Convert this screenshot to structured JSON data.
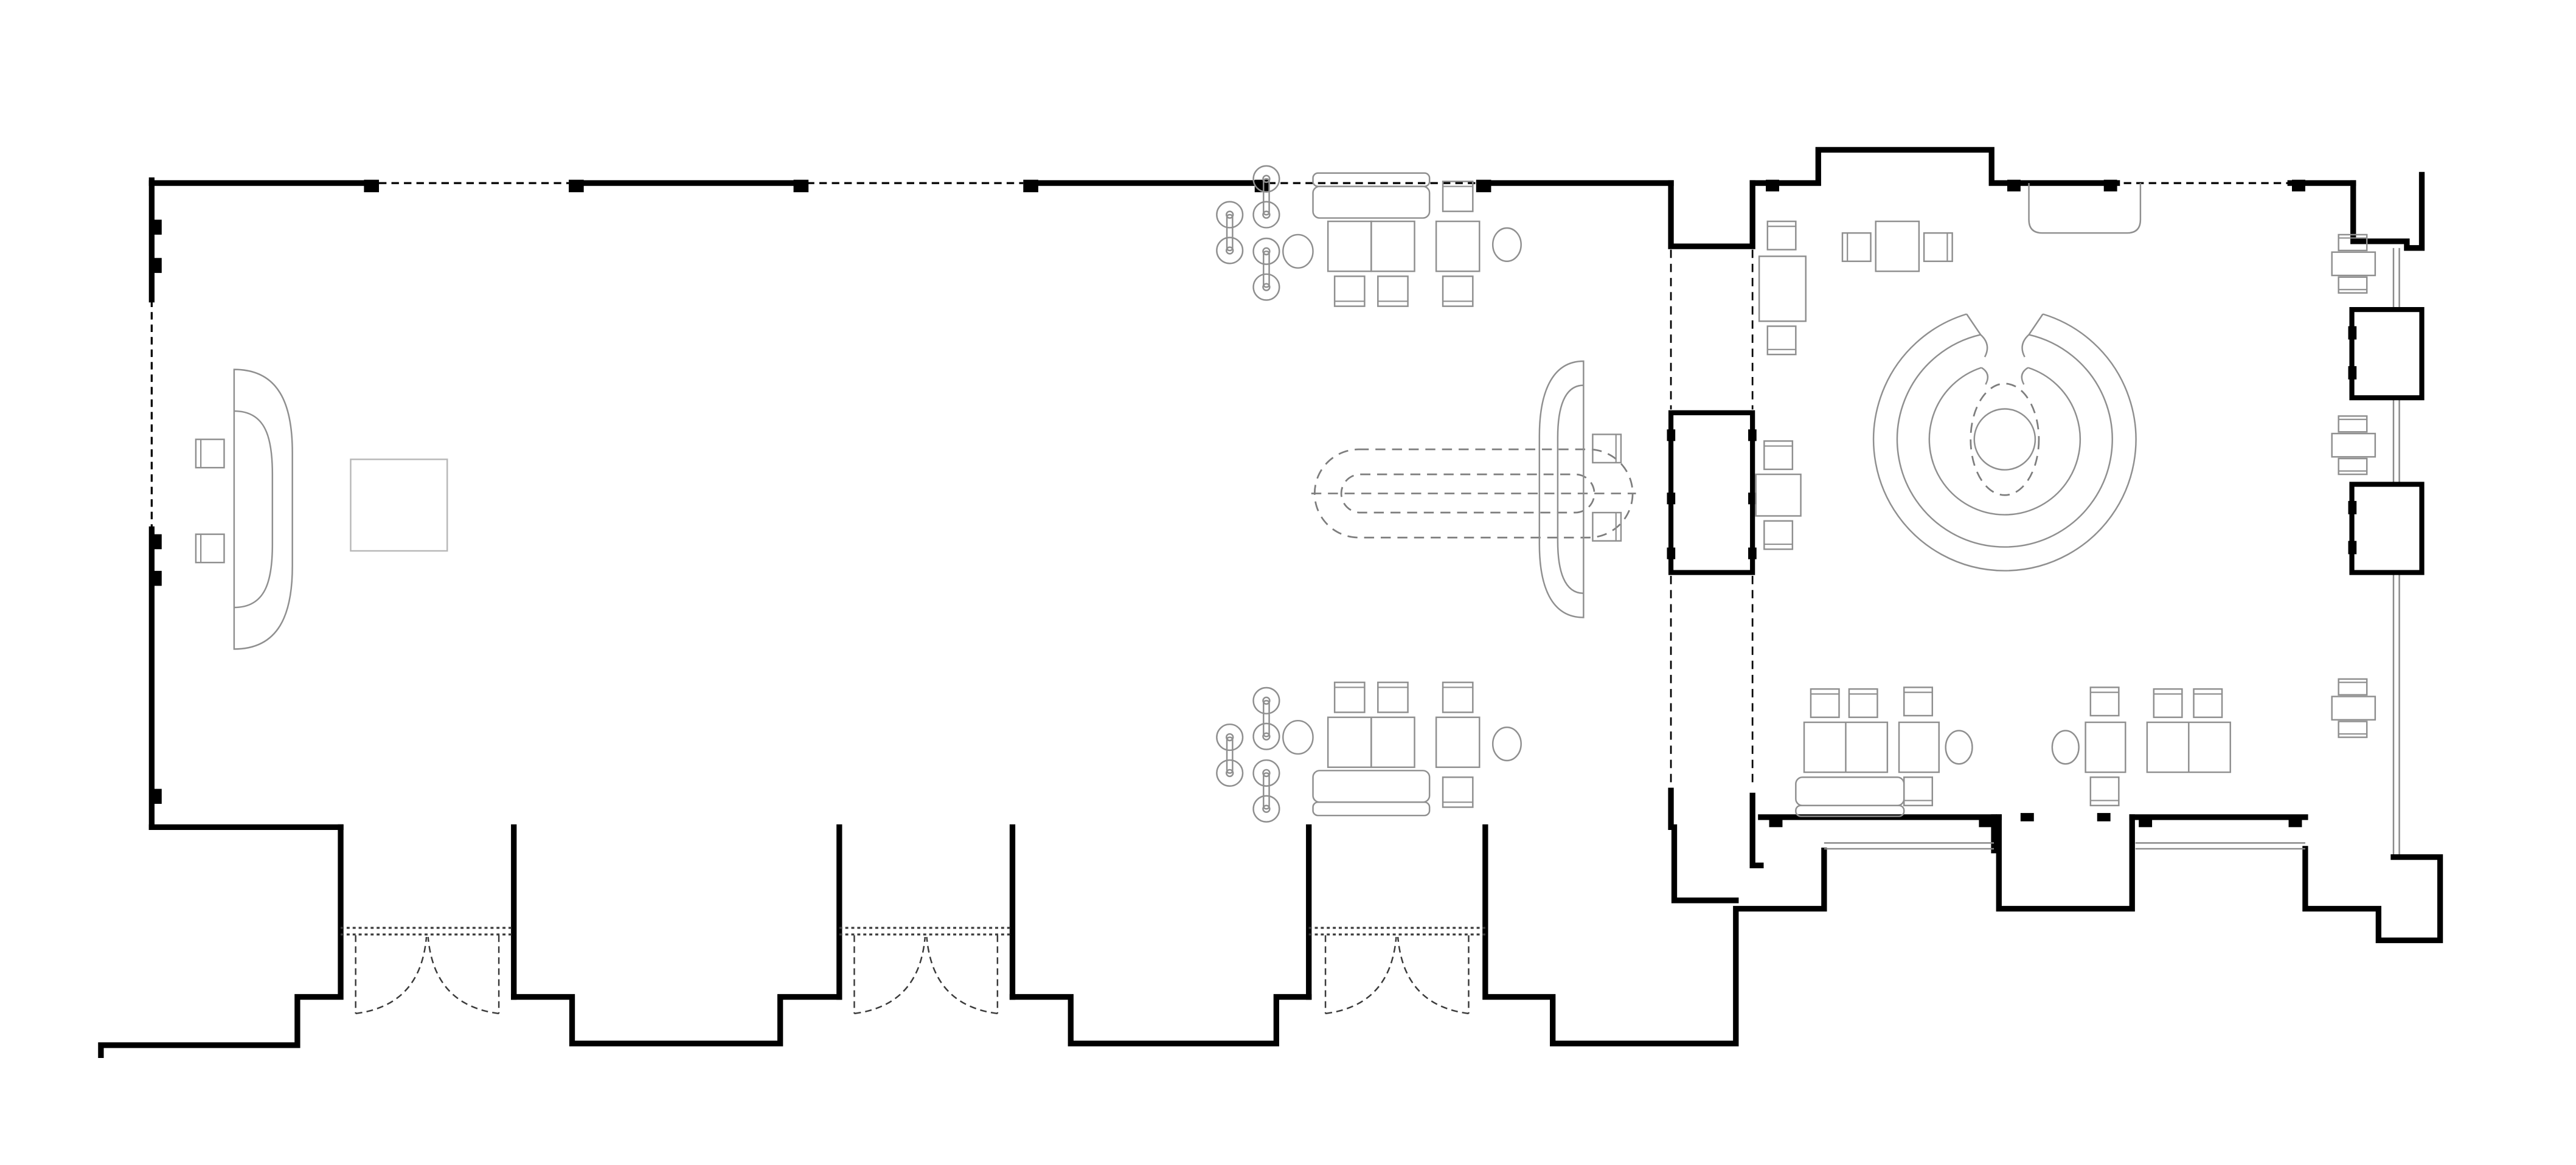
{
  "page": {
    "background": "#ffffff"
  },
  "drawing": {
    "type": "architectural-floor-plan",
    "view": "top-down plan, line drawing, no text labels",
    "colors": {
      "wall": "#000000",
      "furniture": "#8f8f8f",
      "furniture_light": "#b8b8b8",
      "opening_dash": "#3a3a3a",
      "overhead_dash": "#7d7d7d",
      "window": "#8a8a8a",
      "background": "#ffffff"
    },
    "rooms": [
      {
        "id": "main-hall",
        "shape": "long rectangle",
        "wall_pattern": "solid masonry with pilasters alternating with dashed (window) segments",
        "furniture": [
          "curved D-bench with two side chairs and square table (west end)",
          "wall sofa with two cafe tables and two chairs (north, repeated mirrored on south)",
          "cafe table with two chairs and round chair (north and south)",
          "six barbell pendant screens in two staggered columns (north and south)",
          "nested dashed oval overhead canopy with centerline",
          "curved D-bench facing east with two chairs (center-east)"
        ],
        "doors": {
          "count": 3,
          "type": "double-leaf swing doors in stepped exterior bays"
        }
      },
      {
        "id": "east-lounge",
        "shape": "square room with stepped parapet walls and window bays",
        "furniture": [
          "circular tiered C-shaped lounge seating with round center table and dashed inner ring",
          "rounded wall bench (north)",
          "three vertical cafe sets along west side",
          "horizontal cafe set (north center)",
          "three small window tables with paired chairs (east wall)",
          "wall sofa, double table group, two single-table sets, double table group (south row)",
          "two oval chairs (south row)"
        ],
        "doors": {
          "count": 1,
          "type": "recessed south door bay"
        }
      }
    ],
    "connector": {
      "id": "pier-passage",
      "description": "solid pier with dashed opening edges between hall and lounge"
    }
  }
}
